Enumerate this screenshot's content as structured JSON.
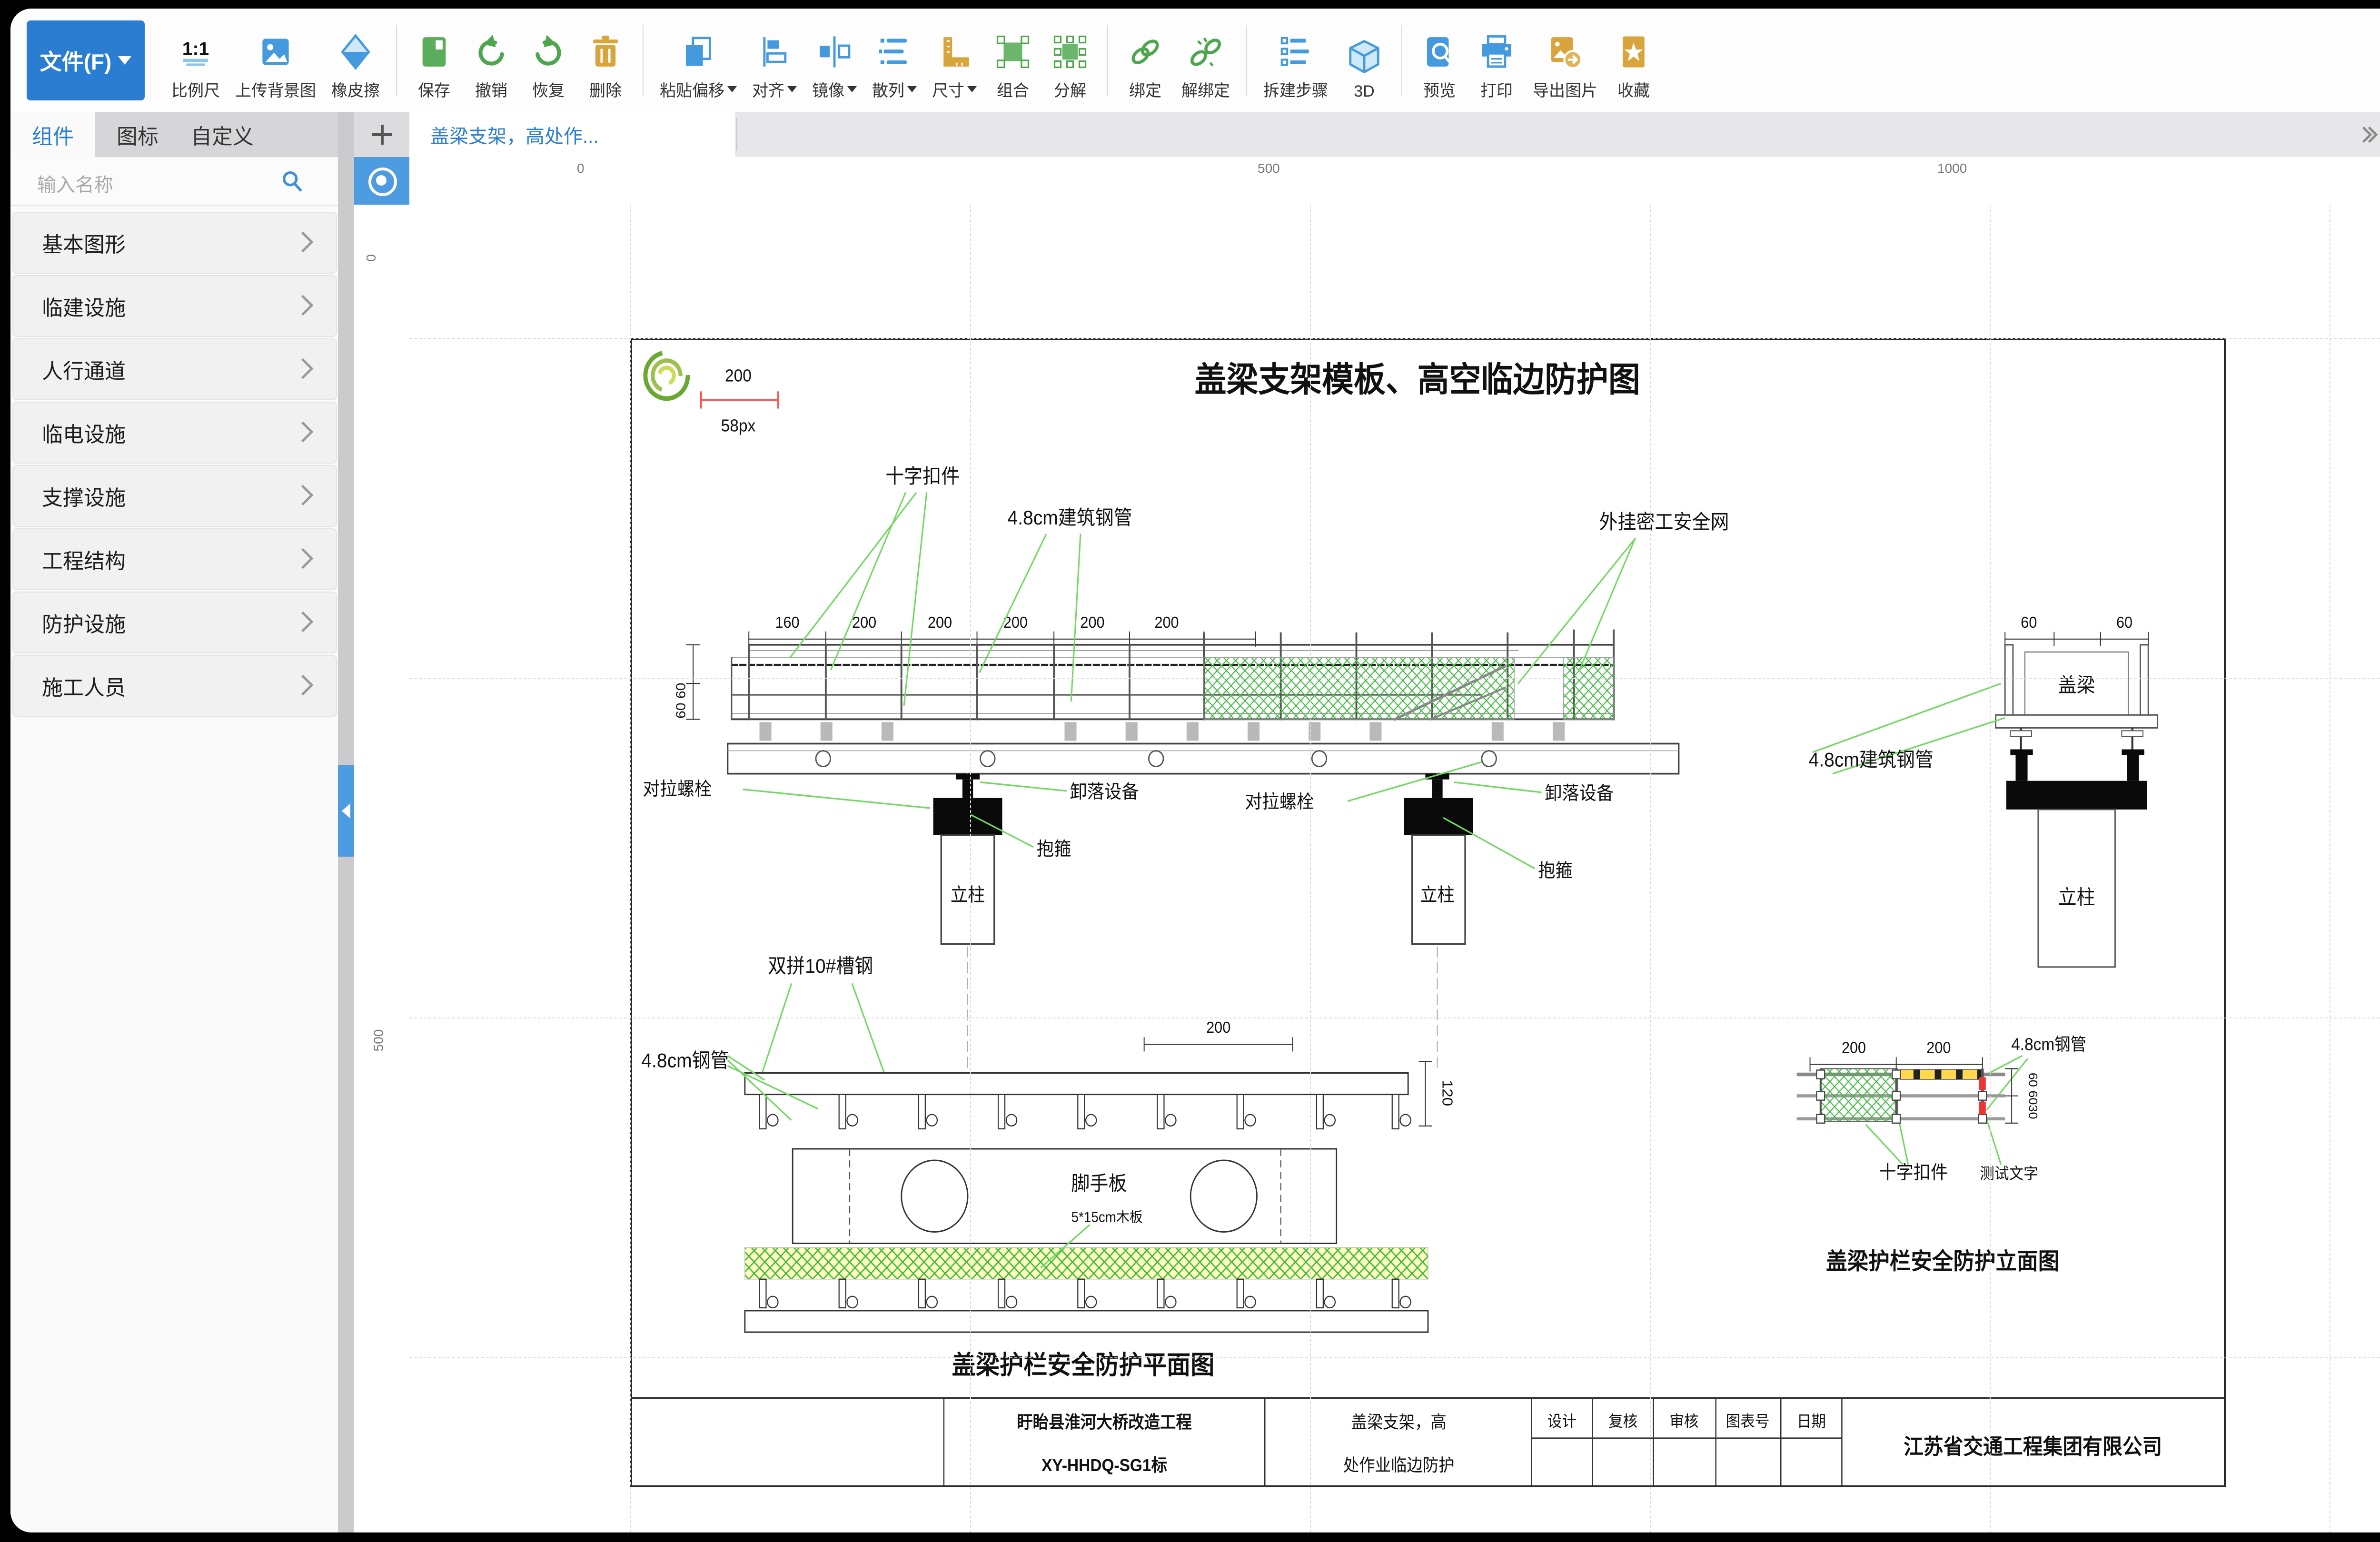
{
  "colors": {
    "accent": "#2b7dd1",
    "icon_blue": "#459ade",
    "icon_green": "#4da64d",
    "icon_orange": "#d9a43c",
    "leader_green": "#72d862",
    "mesh_green": "#3cb83c",
    "fill_color": "#000000",
    "border_color": "#000000",
    "red": "#ff5555"
  },
  "toolbar": {
    "file_button": "文件(F)",
    "scale_icon_text": "1:1",
    "items": [
      {
        "label": "比例尺"
      },
      {
        "label": "上传背景图"
      },
      {
        "label": "橡皮擦"
      },
      {
        "label": "保存"
      },
      {
        "label": "撤销"
      },
      {
        "label": "恢复"
      },
      {
        "label": "删除"
      },
      {
        "label": "粘贴偏移"
      },
      {
        "label": "对齐"
      },
      {
        "label": "镜像"
      },
      {
        "label": "散列"
      },
      {
        "label": "尺寸"
      },
      {
        "label": "组合"
      },
      {
        "label": "分解"
      },
      {
        "label": "绑定"
      },
      {
        "label": "解绑定"
      },
      {
        "label": "拆建步骤"
      },
      {
        "label": "3D"
      },
      {
        "label": "预览"
      },
      {
        "label": "打印"
      },
      {
        "label": "导出图片"
      },
      {
        "label": "收藏"
      }
    ]
  },
  "sidebar": {
    "tabs": [
      "组件",
      "图标",
      "自定义"
    ],
    "search_placeholder": "输入名称",
    "items": [
      {
        "label": "基本图形"
      },
      {
        "label": "临建设施"
      },
      {
        "label": "人行通道"
      },
      {
        "label": "临电设施"
      },
      {
        "label": "支撑设施"
      },
      {
        "label": "工程结构"
      },
      {
        "label": "防护设施"
      },
      {
        "label": "施工人员"
      }
    ]
  },
  "canvas": {
    "tab": "盖梁支架，高处作...",
    "ruler_x": [
      "0",
      "500",
      "1000"
    ],
    "ruler_y": [
      "0",
      "500"
    ]
  },
  "sheet": {
    "title": "盖梁支架模板、高空临边防护图",
    "scale_value": "200",
    "scale_px": "58px",
    "elev": {
      "label_cross": "十字扣件",
      "label_pipe": "4.8cm建筑钢管",
      "label_net": "外挂密工安全网",
      "dims": [
        "160",
        "200",
        "200",
        "200",
        "200",
        "200"
      ],
      "dim_left": "60 60",
      "label_bolt_l": "对拉螺栓",
      "label_release_l": "卸落设备",
      "label_hoop_l": "抱箍",
      "label_bolt_r": "对拉螺栓",
      "label_release_r": "卸落设备",
      "label_hoop_r": "抱箍",
      "label_col_l": "立柱",
      "label_col_r": "立柱",
      "label_channel": "双拼10#槽钢"
    },
    "section": {
      "dims": [
        "60",
        "60"
      ],
      "label_cap": "盖梁",
      "label_col": "立柱",
      "label_pipe": "4.8cm建筑钢管"
    },
    "plan": {
      "dim_top": "200",
      "dim_right": "120",
      "label_pipe": "4.8cm钢管",
      "label_plank": "脚手板",
      "label_plank_sub": "5*15cm木板",
      "caption": "盖梁护栏安全防护平面图"
    },
    "relev": {
      "dims": [
        "200",
        "200"
      ],
      "label_pipe": "4.8cm钢管",
      "dim_right": "60 6030",
      "label_cross": "十字扣件",
      "label_test": "测试文字",
      "caption": "盖梁护栏安全防护立面图"
    },
    "titleblock": {
      "project_line1": "盱眙县淮河大桥改造工程",
      "project_line2": "XY-HHDQ-SG1标",
      "name_line1": "盖梁支架，高",
      "name_line2": "处作业临边防护",
      "cols": [
        "设计",
        "复核",
        "审核",
        "图表号",
        "日期"
      ],
      "company": "江苏省交通工程集团有限公司"
    }
  },
  "props": {
    "tabs": [
      "属性",
      "图层"
    ],
    "rows": [
      {
        "label": "名称",
        "value": "背景",
        "type": "text"
      },
      {
        "label": "锁定",
        "value": "否",
        "type": "select"
      },
      {
        "label": "背景图",
        "value": "空",
        "type": "select"
      },
      {
        "label": "适配背景图",
        "value": "否",
        "type": "select"
      },
      {
        "label": "背景图管理",
        "value": "操作",
        "type": "button"
      },
      {
        "label": "网格吸附",
        "value": "否",
        "type": "select"
      },
      {
        "label": "图层",
        "value": "200",
        "type": "text"
      },
      {
        "label": "比例",
        "value": "87.35%",
        "type": "text"
      },
      {
        "label": "填充颜色",
        "value": "",
        "type": "color"
      },
      {
        "label": "制图框尺寸",
        "value": "自定义",
        "type": "select"
      },
      {
        "label": "边框长度",
        "value": "1200",
        "type": "text"
      },
      {
        "label": "边框高度",
        "value": "800",
        "type": "text"
      },
      {
        "label": "信息框高度",
        "value": "50",
        "type": "text"
      },
      {
        "label": "边框颜色",
        "value": "",
        "type": "color"
      },
      {
        "label": "边框宽度",
        "value": "1",
        "type": "text"
      },
      {
        "label": "对应尺寸(长)",
        "value": "0",
        "type": "text"
      },
      {
        "label": "对应尺寸(高)",
        "value": "0",
        "type": "text"
      },
      {
        "label": "字体大小",
        "value": "24",
        "type": "select"
      },
      {
        "label": "字体类型",
        "value": "Arial",
        "type": "select"
      },
      {
        "label": "X轴辅助线",
        "value": "",
        "type": "empty"
      },
      {
        "label": "Y轴辅助线",
        "value": "",
        "type": "empty"
      }
    ]
  }
}
